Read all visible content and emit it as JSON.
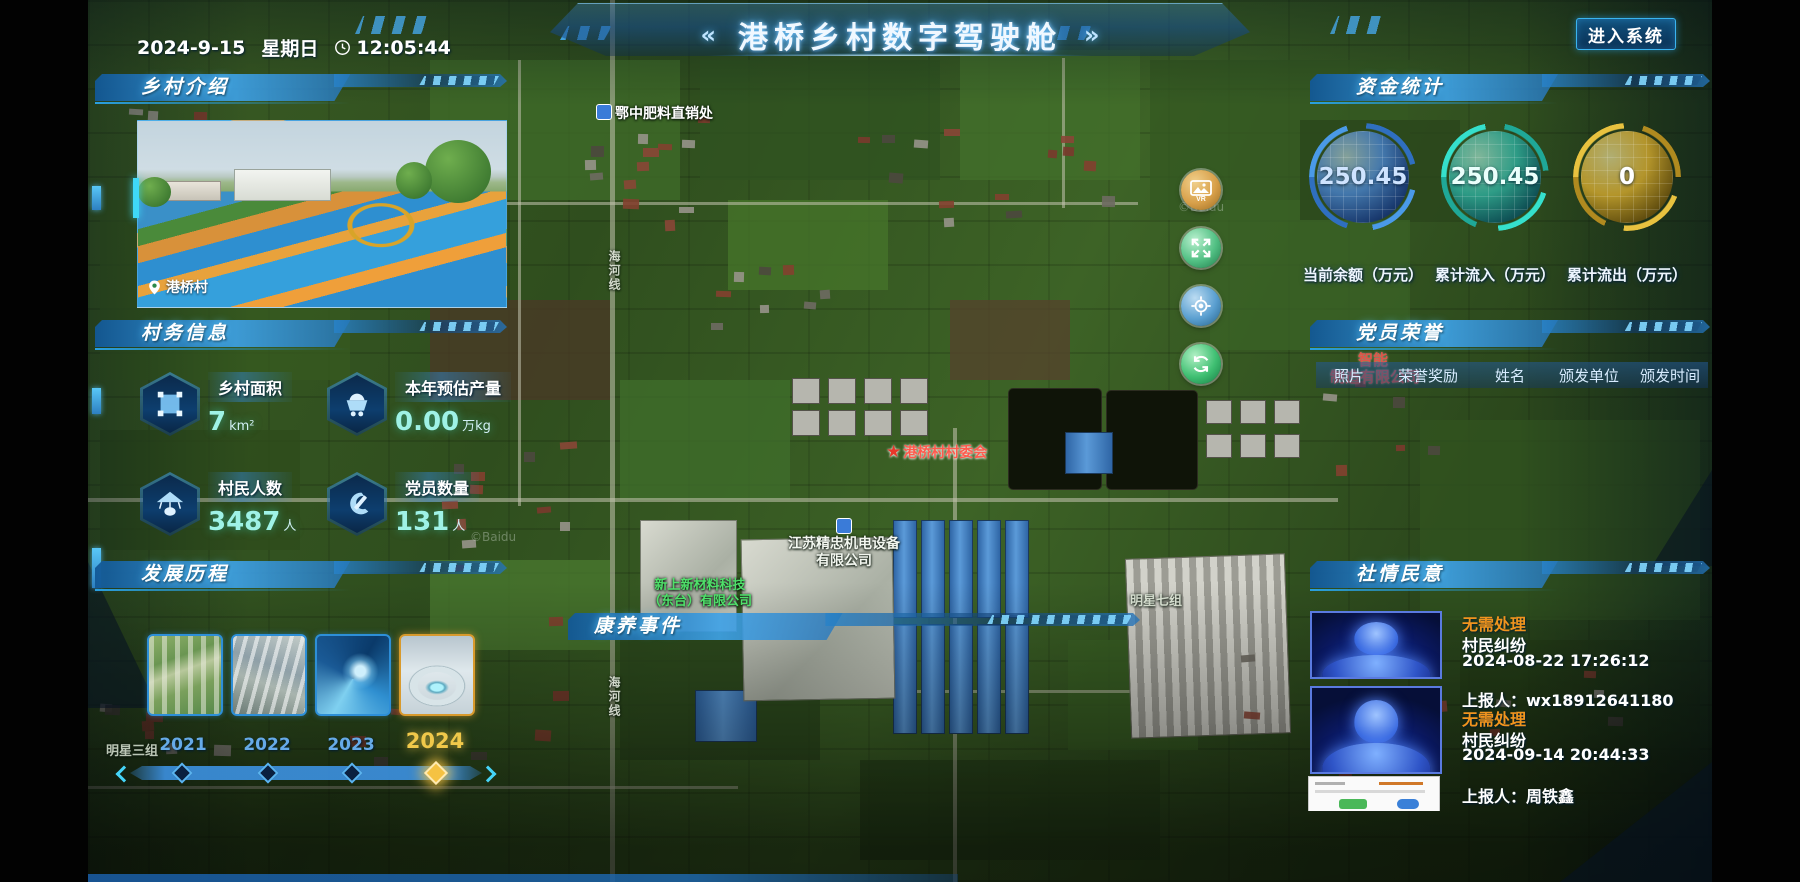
{
  "header": {
    "date": "2024-9-15",
    "weekday": "星期日",
    "time": "12:05:44",
    "left_chevrons": "«",
    "right_chevrons": "»",
    "title": "港桥乡村数字驾驶舱",
    "enter_button": "进入系统"
  },
  "panels": {
    "village_intro": {
      "title": "乡村介绍",
      "photo_location": "港桥村"
    },
    "village_info": {
      "title": "村务信息",
      "stats": [
        {
          "label": "乡村面积",
          "value": "7",
          "unit": "km²",
          "icon": "area-icon"
        },
        {
          "label": "本年预估产量",
          "value": "0.00",
          "unit": "万kg",
          "icon": "cart-icon"
        },
        {
          "label": "村民人数",
          "value": "3487",
          "unit": "人",
          "icon": "villager-icon"
        },
        {
          "label": "党员数量",
          "value": "131",
          "unit": "人",
          "icon": "party-icon"
        }
      ]
    },
    "development": {
      "title": "发展历程",
      "years": [
        {
          "label": "2021"
        },
        {
          "label": "2022"
        },
        {
          "label": "2023"
        },
        {
          "label": "2024"
        }
      ],
      "selected_year": "2024"
    },
    "funds": {
      "title": "资金统计",
      "gauges": [
        {
          "value": "250.45",
          "label": "当前余额（万元）",
          "color": "#3a86d8"
        },
        {
          "value": "250.45",
          "label": "累计流入（万元）",
          "color": "#2ec4b6"
        },
        {
          "value": "0",
          "label": "累计流出（万元）",
          "color": "#d8a828"
        }
      ]
    },
    "party_honor": {
      "title": "党员荣誉",
      "columns": [
        "照片",
        "荣誉奖励",
        "姓名",
        "颁发单位",
        "颁发时间"
      ]
    },
    "public_opinion": {
      "title": "社情民意",
      "items": [
        {
          "status": "无需处理",
          "type": "村民纠纷",
          "time": "2024-08-22 17:26:12",
          "reporter": "上报人：wx18912641180"
        },
        {
          "status": "无需处理",
          "type": "村民纠纷",
          "time": "2024-09-14 20:44:33",
          "reporter": "上报人：周铁鑫"
        }
      ]
    }
  },
  "map": {
    "event_label": "康养事件",
    "pois": {
      "fertilizer": "鄂中肥料直销处",
      "committee": "港桥村村委会",
      "company1_l1": "江苏精忠机电设备",
      "company1_l2": "有限公司",
      "company2_l1": "新上新材料科技",
      "company2_l2": "（东台）有限公司",
      "company3_l1": "智能",
      "company3_l2": "制造有限公司",
      "group7": "明星七组",
      "group3": "明星三组",
      "road": "海河线",
      "watermark": "©Baidu"
    }
  },
  "colors": {
    "accent": "#2ea8e8",
    "selected_year": "#f0c84a",
    "status_pending": "#f0941e"
  }
}
